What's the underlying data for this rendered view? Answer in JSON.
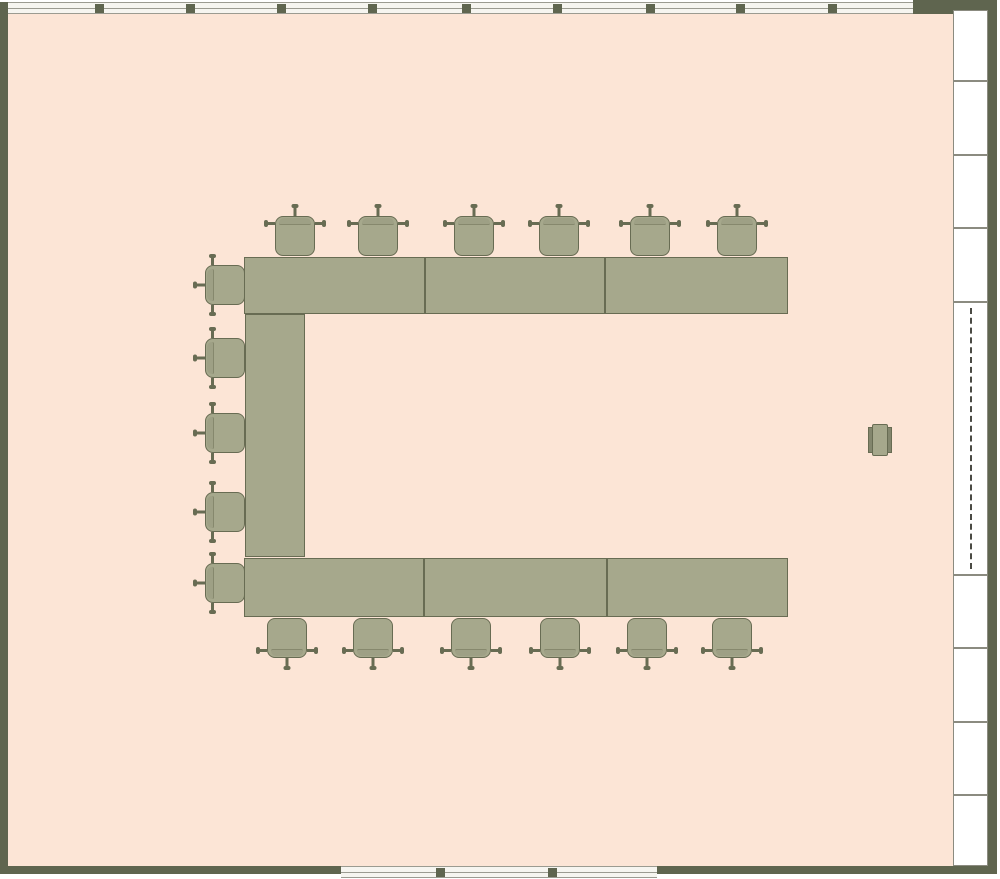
{
  "canvas": {
    "width": 1000,
    "height": 879,
    "background": "#ffffff"
  },
  "palette": {
    "floor": "#fce5d6",
    "wall": "#5f654f",
    "furniture_fill": "#a6a88c",
    "furniture_border": "#686c53",
    "furniture_bar": "#83866d",
    "window_bg": "#f6f5f0",
    "window_line": "#9b9b91",
    "panel_border": "#8b8b80",
    "partition_dash": "#4a4a44"
  },
  "floorplan": {
    "floor": {
      "x": 8,
      "y": 14,
      "w": 945,
      "h": 852
    },
    "walls": [
      {
        "id": "wall-left",
        "x": 0,
        "y": 2,
        "w": 8,
        "h": 872
      },
      {
        "id": "wall-top-right",
        "x": 913,
        "y": 0,
        "w": 84,
        "h": 14
      },
      {
        "id": "wall-right",
        "x": 988,
        "y": 0,
        "w": 9,
        "h": 874
      },
      {
        "id": "wall-bottom-left",
        "x": 0,
        "y": 866,
        "w": 341,
        "h": 8
      },
      {
        "id": "wall-bottom-right",
        "x": 657,
        "y": 866,
        "w": 340,
        "h": 8
      }
    ],
    "windows": [
      {
        "id": "window-band-top",
        "x": 8,
        "y": 2,
        "w": 905,
        "h": 12,
        "mullions_x": [
          99,
          190,
          281,
          372,
          466,
          557,
          650,
          740,
          832
        ]
      },
      {
        "id": "window-band-bottom",
        "x": 341,
        "y": 866,
        "w": 316,
        "h": 12,
        "mullions_x": [
          440,
          552
        ]
      }
    ],
    "wall_panels": [
      {
        "id": "wall-panel-1",
        "x": 953,
        "y": 10,
        "w": 35,
        "h": 71
      },
      {
        "id": "wall-panel-2",
        "x": 953,
        "y": 81,
        "w": 35,
        "h": 74
      },
      {
        "id": "wall-panel-3",
        "x": 953,
        "y": 155,
        "w": 35,
        "h": 73
      },
      {
        "id": "wall-panel-4",
        "x": 953,
        "y": 228,
        "w": 35,
        "h": 74
      },
      {
        "id": "wall-panel-5",
        "x": 953,
        "y": 575,
        "w": 35,
        "h": 73
      },
      {
        "id": "wall-panel-6",
        "x": 953,
        "y": 648,
        "w": 35,
        "h": 74
      },
      {
        "id": "wall-panel-7",
        "x": 953,
        "y": 722,
        "w": 35,
        "h": 73
      },
      {
        "id": "wall-panel-8",
        "x": 953,
        "y": 795,
        "w": 35,
        "h": 71
      }
    ],
    "partition": {
      "id": "sliding-partition",
      "x": 953,
      "y": 302,
      "w": 35,
      "h": 273
    },
    "tables": [
      {
        "id": "table-top-1",
        "x": 244,
        "y": 257,
        "w": 181,
        "h": 57
      },
      {
        "id": "table-top-2",
        "x": 425,
        "y": 257,
        "w": 180,
        "h": 57
      },
      {
        "id": "table-top-3",
        "x": 605,
        "y": 257,
        "w": 183,
        "h": 57
      },
      {
        "id": "table-left",
        "x": 245,
        "y": 314,
        "w": 60,
        "h": 243
      },
      {
        "id": "table-bottom-1",
        "x": 244,
        "y": 558,
        "w": 180,
        "h": 59
      },
      {
        "id": "table-bottom-2",
        "x": 424,
        "y": 558,
        "w": 183,
        "h": 59
      },
      {
        "id": "table-bottom-3",
        "x": 607,
        "y": 558,
        "w": 181,
        "h": 59
      }
    ],
    "chairs": [
      {
        "cx": 295,
        "cy": 236,
        "facing": "down"
      },
      {
        "cx": 378,
        "cy": 236,
        "facing": "down"
      },
      {
        "cx": 474,
        "cy": 236,
        "facing": "down"
      },
      {
        "cx": 559,
        "cy": 236,
        "facing": "down"
      },
      {
        "cx": 650,
        "cy": 236,
        "facing": "down"
      },
      {
        "cx": 737,
        "cy": 236,
        "facing": "down"
      },
      {
        "cx": 225,
        "cy": 285,
        "facing": "right"
      },
      {
        "cx": 225,
        "cy": 358,
        "facing": "right"
      },
      {
        "cx": 225,
        "cy": 433,
        "facing": "right"
      },
      {
        "cx": 225,
        "cy": 512,
        "facing": "right"
      },
      {
        "cx": 225,
        "cy": 583,
        "facing": "right"
      },
      {
        "cx": 287,
        "cy": 638,
        "facing": "up"
      },
      {
        "cx": 373,
        "cy": 638,
        "facing": "up"
      },
      {
        "cx": 471,
        "cy": 638,
        "facing": "up"
      },
      {
        "cx": 560,
        "cy": 638,
        "facing": "up"
      },
      {
        "cx": 647,
        "cy": 638,
        "facing": "up"
      },
      {
        "cx": 732,
        "cy": 638,
        "facing": "up"
      }
    ],
    "side_chair": {
      "id": "side-chair",
      "x": 868,
      "y": 424,
      "w": 24,
      "h": 32
    }
  }
}
